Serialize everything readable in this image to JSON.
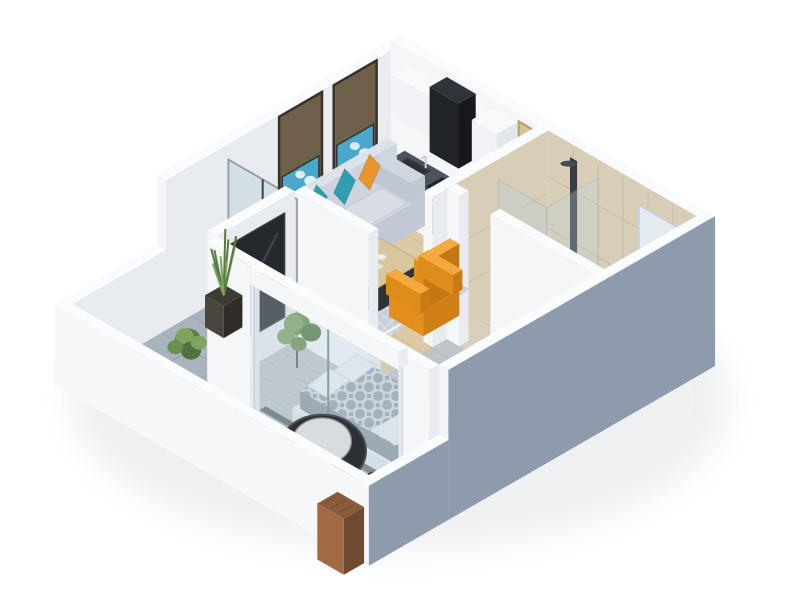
{
  "title": "3D isometric floor plan render of a one-bedroom apartment",
  "view": "isometric-overhead",
  "colors": {
    "bg": "#ffffff",
    "wall_top": "#fafbfd",
    "wall_lit": "#f4f6f8",
    "wall_side": "#e8ebf0",
    "wall_ext": "#8e9bac",
    "parapet_outer": "#f6f8fa",
    "floor_wood": "#dccaa5",
    "floor_wood_line": "#cbb894",
    "floor_gray": "#c0c3c8",
    "floor_gray_line": "#aeb2b8",
    "floor_tile": "#a9b3be",
    "floor_tile_line": "#96a1ad",
    "floor_bath": "#d9cfbc",
    "floor_bath_line": "#c9bfa9",
    "tile_wall": "#d8cdb7",
    "tile_line": "#c6baa1",
    "counter": "#4e545e",
    "cabinet": "#f0f2f5",
    "cabinet_side": "#e3e7ed",
    "cabinet_top": "#f7f9fb",
    "appliance_dark": "#23262b",
    "hood_front": "#202328",
    "door_wood": "#d8c192",
    "door_trim": "#b69d6e",
    "glass": "#bcd4dc",
    "glass_frame": "#3f444b",
    "art_board": "#6f6049",
    "art_frame": "#37332c",
    "art_blue": "#49a8cc",
    "art_white": "#e9f3f7",
    "sofa_top": "#d4dae2",
    "sofa_front": "#c2c9d5",
    "sofa_side": "#c6cdd8",
    "sofa_seat": "#d8dde5",
    "pillow_orange": "#e8952e",
    "pillow_teal": "#2e9db0",
    "rug": "#c9cfda",
    "rug_border": "#eef0f4",
    "table_wood": "#d9c69e",
    "table_dark": "#2f3339",
    "armchair": "#f1a335",
    "armchair_front": "#e28f1e",
    "armchair_side": "#d07f16",
    "tv": "#25282d",
    "bed_duvet": "#9ba3af",
    "bed_white": "#eef0f3",
    "bed_front": "#e0e4ea",
    "bed_side": "#d5dbe2",
    "plant_green": "#6b9150",
    "plant_light": "#7fa45f",
    "plant_dark": "#577a41",
    "pot": "#3e3a34",
    "chair_black": "#2d3034",
    "cushion": "#d9dcdf",
    "stool": "#3a3e44",
    "planter_top": "#8a5c3b",
    "planter_front": "#a06a45",
    "planter_side": "#6f4a30",
    "vanity_top": "#d9c7a0",
    "vanity_front": "#cdbb92",
    "vanity_side": "#b9a67e"
  },
  "scene": {
    "rooms": [
      {
        "id": "living-room",
        "label": "Living room",
        "floor": "light wood"
      },
      {
        "id": "kitchen",
        "label": "Kitchen",
        "floor": "light wood"
      },
      {
        "id": "bathroom",
        "label": "Bathroom",
        "floor": "beige tile"
      },
      {
        "id": "hallway",
        "label": "Hallway",
        "floor": "gray wood"
      },
      {
        "id": "bedroom",
        "label": "Bedroom",
        "floor": "gray wood"
      },
      {
        "id": "balcony",
        "label": "Balcony",
        "floor": "gray tile"
      }
    ],
    "furniture": [
      {
        "id": "art-panels",
        "label": "Two blue artwork panels on bronze boards"
      },
      {
        "id": "sofa",
        "label": "Light gray three-seat sofa"
      },
      {
        "id": "throw-pillows",
        "label": "Orange and teal throw pillows"
      },
      {
        "id": "area-rug",
        "label": "Gray trellis rug"
      },
      {
        "id": "coffee-table",
        "label": "Wood-top coffee table with dark base"
      },
      {
        "id": "armchair",
        "label": "Orange high-back armchair"
      },
      {
        "id": "tv-panel",
        "label": "Dark TV / glass partition panel"
      },
      {
        "id": "kitchen-cabinets",
        "label": "White kitchen cabinets with dark counter"
      },
      {
        "id": "range-hood",
        "label": "Black range hood"
      },
      {
        "id": "kitchen-sink",
        "label": "Kitchen sink with faucet"
      },
      {
        "id": "cooktop-oven",
        "label": "Dark cooktop and oven"
      },
      {
        "id": "tall-cabinet",
        "label": "Tall white cabinet column"
      },
      {
        "id": "entry-door",
        "label": "Wooden entry door"
      },
      {
        "id": "shower",
        "label": "Glass shower enclosure with dark column"
      },
      {
        "id": "vanity-sink",
        "label": "Wood vanity with white basin"
      },
      {
        "id": "mirror",
        "label": "Bathroom mirror"
      },
      {
        "id": "toilet",
        "label": "Toilet"
      },
      {
        "id": "laundry-basket",
        "label": "Wicker basket"
      },
      {
        "id": "bed",
        "label": "Double bed with gray patterned duvet"
      },
      {
        "id": "bed-pillows",
        "label": "White bed pillows"
      },
      {
        "id": "nightstand",
        "label": "White nightstand"
      },
      {
        "id": "bedroom-plant",
        "label": "Potted plant in bedroom"
      },
      {
        "id": "balcony-grass-plant",
        "label": "Tall grass plant in tapered pot"
      },
      {
        "id": "balcony-bush",
        "label": "Green shrub on balcony"
      },
      {
        "id": "egg-chair",
        "label": "Black round egg chair with gray cushion"
      },
      {
        "id": "side-tables",
        "label": "Two dark round side stools"
      },
      {
        "id": "wood-planter",
        "label": "Wooden planter box at balcony corner"
      },
      {
        "id": "living-glass-slider",
        "label": "Glass slider living room to balcony"
      },
      {
        "id": "bedroom-window",
        "label": "Bedroom sliding window to balcony"
      }
    ]
  }
}
